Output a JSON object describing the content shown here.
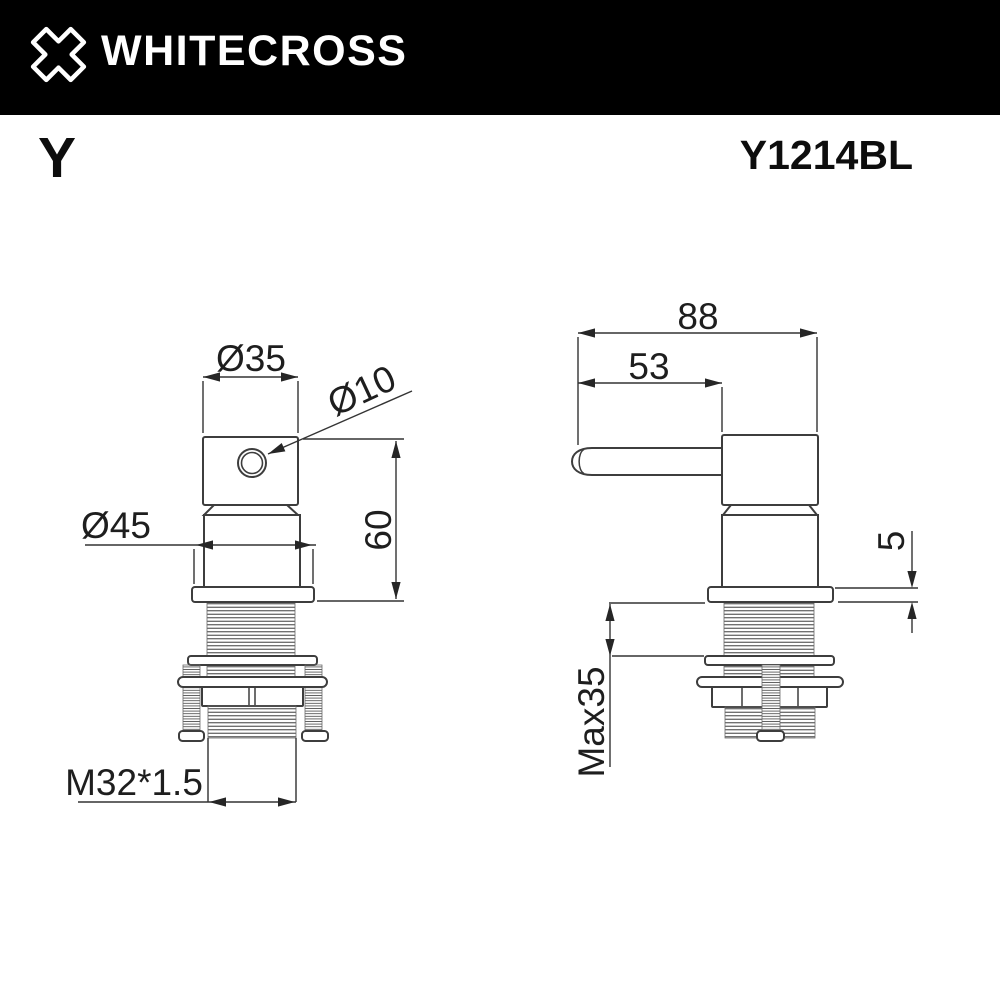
{
  "header": {
    "brand": "WHITECROSS",
    "logo_icon": "x-cross",
    "background": "#000000",
    "text_color": "#ffffff"
  },
  "doc": {
    "series_letter": "Y",
    "model_code": "Y1214BL"
  },
  "views": {
    "front": {
      "dims": {
        "top_diameter": "Ø35",
        "hole_diameter": "Ø10",
        "escutcheon_diameter": "Ø45",
        "body_height": "60",
        "thread_spec": "M32*1.5"
      }
    },
    "side": {
      "dims": {
        "total_length": "88",
        "handle_length": "53",
        "escutcheon_thickness": "5",
        "max_mounting_thickness": "Max35"
      }
    }
  },
  "colors": {
    "drawing_line": "#3d3d3d",
    "dim_text": "#1e1e1e"
  }
}
